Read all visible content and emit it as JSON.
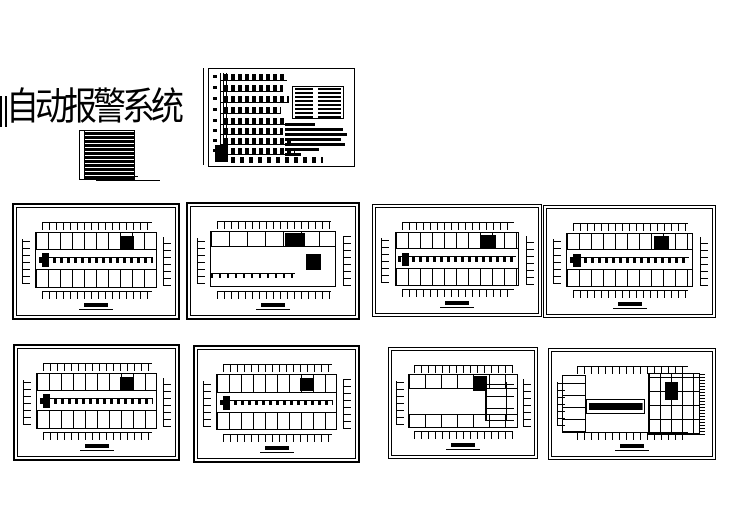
{
  "header": {
    "title": "自动报警系统"
  },
  "colors": {
    "ink": "#000000",
    "paper": "#ffffff"
  },
  "layout": {
    "sheet_count": 9,
    "floor_plan_count": 8,
    "riser_floor_count": 8
  }
}
